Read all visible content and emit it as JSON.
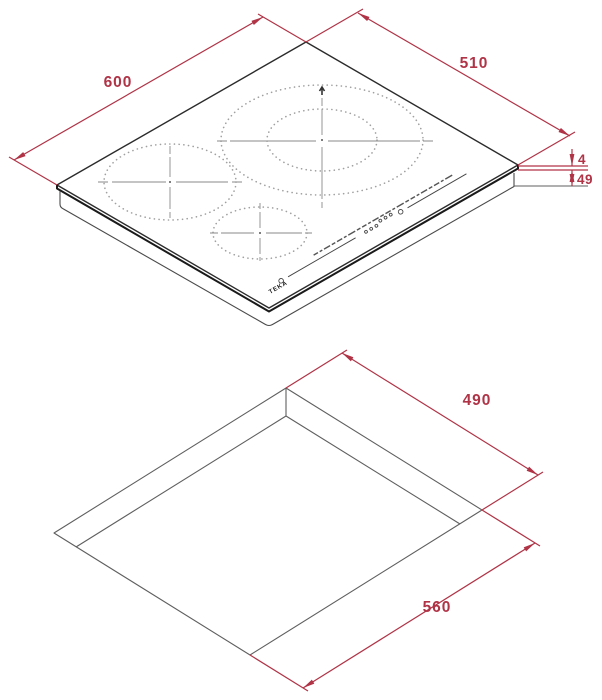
{
  "drawing": {
    "brand_logo": "TEKA",
    "hob_view": {
      "width_label": "600",
      "depth_label": "510",
      "glass_height_label": "4",
      "total_height_label": "49"
    },
    "cutout_view": {
      "depth_label": "490",
      "width_label": "560"
    },
    "colors": {
      "dimension_red": "#b03346",
      "outline_black": "#2b2b2b",
      "cutout_gray": "#5f5f5f",
      "zone_dot_gray": "#a0a0a0",
      "crosshair_gray": "#8a8a8a"
    }
  }
}
